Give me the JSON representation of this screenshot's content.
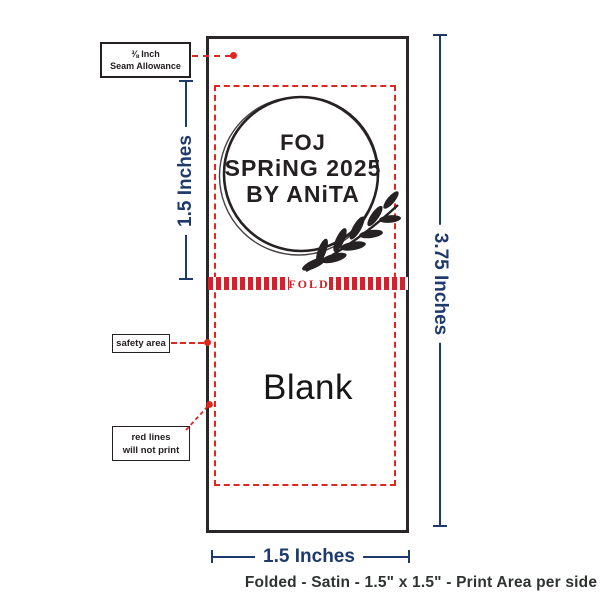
{
  "colors": {
    "ink": "#242021",
    "red": "#e0271f",
    "fold_bar_red": "#cd2430",
    "navy": "#1e3a6d",
    "caption": "#2e3330",
    "background": "#ffffff"
  },
  "label": {
    "front": {
      "line1": "FOJ",
      "line2": "SPRiNG 2025",
      "line3": "BY ANiTA"
    },
    "fold_marker": "FOLD",
    "back": "Blank"
  },
  "callouts": {
    "seam": {
      "line1": "⅜ Inch",
      "line2": "Seam Allowance"
    },
    "safety": {
      "label": "safety area"
    },
    "red_lines": {
      "line1": "red lines",
      "line2": "will not print"
    }
  },
  "measurements": {
    "fold_half": "1.5 Inches",
    "total_height": "3.75 Inches",
    "width": "1.5 Inches"
  },
  "footer": {
    "caption": "Folded - Satin - 1.5\" x 1.5\" - Print Area per side"
  }
}
